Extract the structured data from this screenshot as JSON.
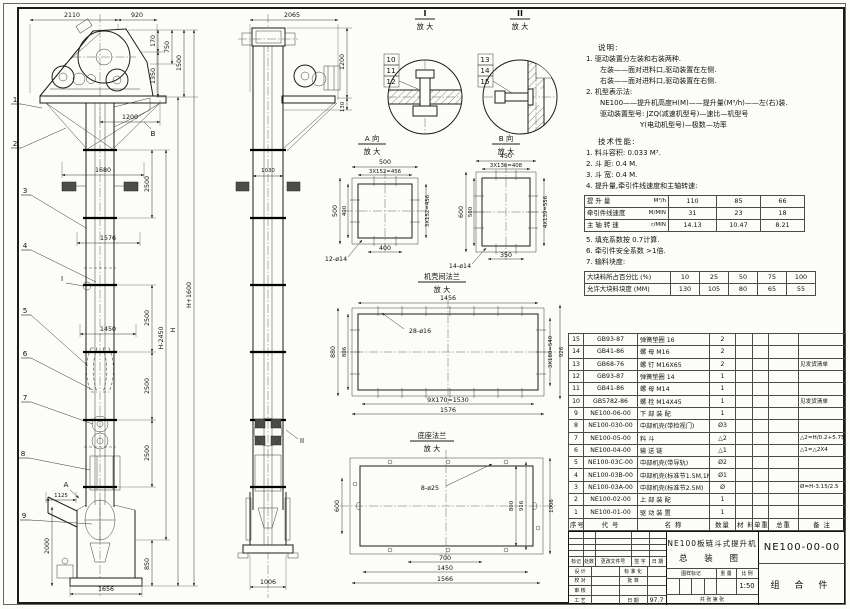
{
  "front": {
    "balloons": [
      "1",
      "2",
      "3",
      "4",
      "5",
      "6",
      "7",
      "8",
      "9"
    ],
    "d2110": "2110",
    "d920": "920",
    "d170": "170",
    "d750": "750",
    "d1350": "1350",
    "d1500": "1500",
    "d1200": "1200",
    "d1680": "1680",
    "d1576": "1576",
    "d1450": "1450",
    "d2500": "2500",
    "dH1600": "H+1600",
    "dH2450": "H-2450",
    "dH": "H",
    "d1125": "1125",
    "d2000": "2000",
    "d850": "850",
    "d1656": "1656",
    "mA": "A",
    "mB": "B",
    "mI": "I"
  },
  "side": {
    "d2065": "2065",
    "d1200": "1200",
    "d130": "130",
    "d1030": "1030",
    "d1006": "1006",
    "mII": "II"
  },
  "detailI": {
    "title": "I",
    "sub": "放 大",
    "balloons": [
      "10",
      "11",
      "12"
    ]
  },
  "detailII": {
    "title": "II",
    "sub": "放 大",
    "balloons": [
      "13",
      "14",
      "15"
    ]
  },
  "viewA": {
    "title": "A 向",
    "sub": "放 大",
    "d500": "500",
    "d3x152": "3X152=456",
    "d400": "400",
    "holes": "12-ø14"
  },
  "viewB": {
    "title": "B 向",
    "sub": "放 大",
    "d450": "450",
    "d3x136": "3X136=408",
    "d600": "600",
    "d500": "500",
    "d350": "350",
    "d4x139": "4X139=556",
    "holes": "14-ø14"
  },
  "flange": {
    "title": "机壳间法兰",
    "sub": "放 大",
    "d1456": "1456",
    "holes": "28-ø16",
    "d880": "880",
    "d806": "806",
    "d3x180": "3X180=540",
    "d926": "926",
    "d9x170": "9X170=1530",
    "d1576": "1576"
  },
  "base": {
    "title": "底座法兰",
    "sub": "放 大",
    "holes": "8-ø25",
    "d600": "600",
    "d800": "800",
    "d916": "916",
    "d1006": "1006",
    "d700": "700",
    "d1450": "1450",
    "d1566": "1566"
  },
  "notes": {
    "title": "说明:",
    "lines": [
      "1. 驱动装置分左装和右装两种.",
      "左装——面对进料口,驱动装置在左侧.",
      "右装——面对进料口,驱动装置在右侧.",
      "2. 机型表示法:",
      "NE100——提升机高度H(M)——提升量(M³/h)——左(右)装.",
      "驱动装置型号: JZQ(减速机型号)—速比—机型号",
      "Y(电动机型号)—极数—功率"
    ]
  },
  "tech": {
    "title": "技术性能:",
    "items": [
      "1. 料斗容积: 0.033 M³.",
      "2. 斗  距: 0.4 M.",
      "3. 斗  宽: 0.4 M.",
      "4. 提升量,牵引件线速度和主轴转速:"
    ],
    "notes2": [
      "5. 填充系数按 0.7计算.",
      "6. 牵引件安全系数 >1倍.",
      "7. 输料块度:"
    ],
    "perf": {
      "rows": [
        {
          "label": "提 升 量",
          "unit": "M³/h",
          "values": [
            "110",
            "85",
            "66"
          ]
        },
        {
          "label": "牵引件线速度",
          "unit": "M/MIN",
          "values": [
            "31",
            "23",
            "18"
          ]
        },
        {
          "label": "主 轴 转 速",
          "unit": "r/MIN",
          "values": [
            "14.13",
            "10.47",
            "8.21"
          ]
        }
      ]
    },
    "blocks": {
      "rows": [
        {
          "label": "大块料所占百分比 (%)",
          "values": [
            "10",
            "25",
            "50",
            "75",
            "100"
          ]
        },
        {
          "label": "允许大块料块度 (MM)",
          "values": [
            "130",
            "105",
            "80",
            "65",
            "55"
          ]
        }
      ]
    }
  },
  "bom": {
    "headers": [
      "序号",
      "代  号",
      "名  称",
      "数量",
      "材 料",
      "单重",
      "总重",
      "备  注"
    ],
    "rows": [
      [
        "15",
        "GB93-87",
        "弹簧垫圈 16",
        "2",
        "",
        "",
        "",
        ""
      ],
      [
        "14",
        "GB41-86",
        "螺 母 M16",
        "2",
        "",
        "",
        "",
        ""
      ],
      [
        "13",
        "GB68-76",
        "螺 钉 M16X65",
        "2",
        "",
        "",
        "",
        "见发货清单"
      ],
      [
        "12",
        "GB93-87",
        "弹簧垫圈 14",
        "1",
        "",
        "",
        "",
        ""
      ],
      [
        "11",
        "GB41-86",
        "螺 母 M14",
        "1",
        "",
        "",
        "",
        ""
      ],
      [
        "10",
        "GB5782-86",
        "螺 栓 M14X45",
        "1",
        "",
        "",
        "",
        "见发货清单"
      ],
      [
        "9",
        "NE100-06-00",
        "下 部 装 配",
        "1",
        "",
        "",
        "",
        ""
      ],
      [
        "8",
        "NE100-030-00",
        "中部机壳(带检视门)",
        "Ø3",
        "",
        "",
        "",
        ""
      ],
      [
        "7",
        "NE100-05-00",
        "料 斗",
        "△2",
        "",
        "",
        "",
        "△2=H/0.2+5.75"
      ],
      [
        "6",
        "NE100-04-00",
        "输 送 链",
        "△1",
        "",
        "",
        "",
        "△1=△2X4"
      ],
      [
        "5",
        "NE100-03C-00",
        "中部机壳(带导轨)",
        "Ø2",
        "",
        "",
        "",
        ""
      ],
      [
        "4",
        "NE100-03B-00",
        "中部机壳(标准节1.5M,1M)",
        "Ø1",
        "",
        "",
        "",
        ""
      ],
      [
        "3",
        "NE100-03A-00",
        "中部机壳(标准节2.5M)",
        "Ø",
        "",
        "",
        "",
        "Ø=H-3.15/2.5"
      ],
      [
        "2",
        "NE100-02-00",
        "上 部 装 配",
        "1",
        "",
        "",
        "",
        ""
      ],
      [
        "1",
        "NE100-01-00",
        "驱 动 装 置",
        "1",
        "",
        "",
        "",
        ""
      ]
    ]
  },
  "titleblock": {
    "product": "NE100板链斗式提升机",
    "sheet_name": "总 装 图",
    "code": "NE100-00-00",
    "part": "组 合 件",
    "scale": "1:50",
    "date": "97.7",
    "l_mark": "标记",
    "l_count": "处数",
    "l_doc": "更改文件号",
    "l_sign": "签 字",
    "l_date": "日 期",
    "l_design": "设 计",
    "l_std": "标 准 化",
    "l_check": "校 对",
    "l_approve": "批 准",
    "l_review": "审 核",
    "l_process": "工 艺",
    "l_date2": "日 期",
    "l_stamp": "图样标记",
    "l_weight": "重 量",
    "l_scale": "比 例",
    "l_sheets": "共    张   第    张"
  }
}
